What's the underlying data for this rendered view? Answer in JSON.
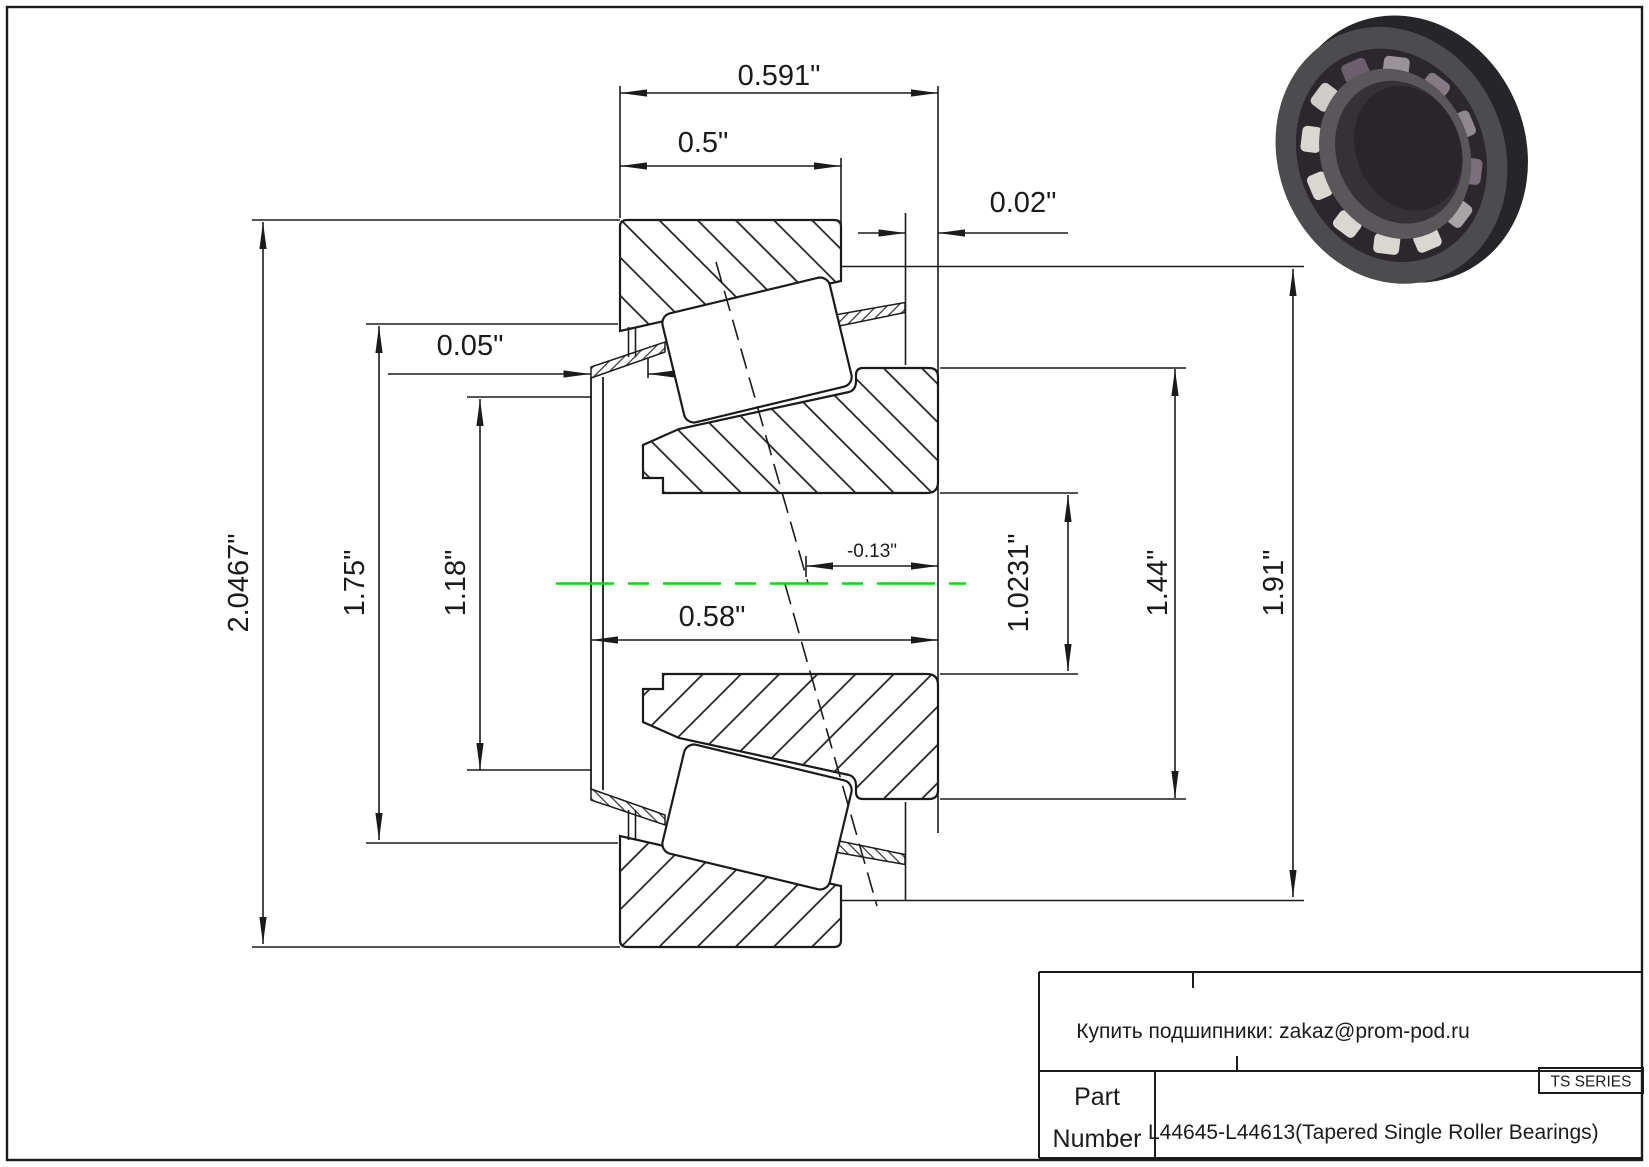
{
  "page": {
    "background": "#ffffff",
    "line_color": "#1b1b1b",
    "centerline_color": "#00dd00"
  },
  "dimensions": {
    "total_width": "0.591\"",
    "cup_width": "0.5\"",
    "cup_standout": "0.02\"",
    "cage_clearance": "0.05\"",
    "flange_od": "2.0467\"",
    "flange_pilot_od": "1.75\"",
    "cage_od": "1.18\"",
    "effective_center": "-0.13\"",
    "bearing_width": "0.58\"",
    "bore_diameter": "1.0231\"",
    "cone_rib_od": "1.44\"",
    "cup_od": "1.91\""
  },
  "title_block": {
    "contact": "Купить подшипники: zakaz@prom-pod.ru",
    "series": "TS SERIES",
    "part_label_line1": "Part",
    "part_label_line2": "Number",
    "part_number": "L44645-L44613(Tapered Single Roller Bearings)"
  }
}
